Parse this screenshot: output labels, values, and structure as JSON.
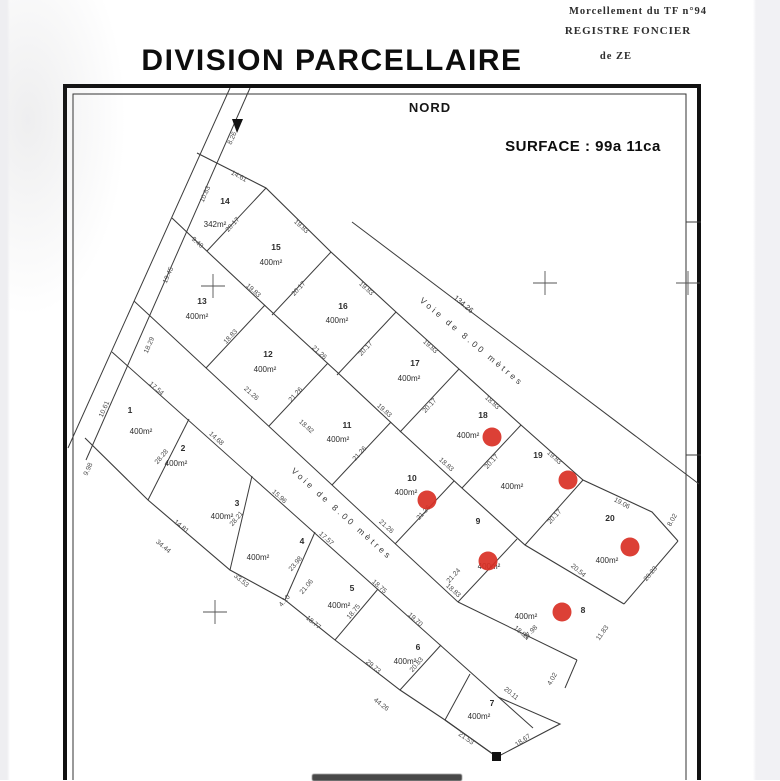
{
  "header": {
    "line1": "Morcellement  du  TF  n°94",
    "line2": "REGISTRE  FONCIER",
    "line3": "de  ZE"
  },
  "title": "DIVISION PARCELLAIRE",
  "north_label": "NORD",
  "surface_label": "SURFACE : 99a 11ca",
  "road_label": "Voie  de  8.00  mètres",
  "road1_length": "134.26",
  "colors": {
    "dot": "#d93025",
    "line": "#3c3c3c",
    "text": "#3a3a3a",
    "frame": "#111111"
  },
  "parcels": [
    {
      "num": "14",
      "area": "342m²",
      "nx": 225,
      "ny": 204,
      "ax": 215,
      "ay": 227
    },
    {
      "num": "15",
      "area": "400m²",
      "nx": 276,
      "ny": 250,
      "ax": 271,
      "ay": 265
    },
    {
      "num": "16",
      "area": "400m²",
      "nx": 343,
      "ny": 309,
      "ax": 337,
      "ay": 323
    },
    {
      "num": "17",
      "area": "400m²",
      "nx": 415,
      "ny": 366,
      "ax": 409,
      "ay": 381
    },
    {
      "num": "18",
      "area": "400m²",
      "nx": 483,
      "ny": 418,
      "ax": 468,
      "ay": 438,
      "dx": 492,
      "dy": 437
    },
    {
      "num": "19",
      "area": "400m²",
      "nx": 538,
      "ny": 458,
      "ax": 512,
      "ay": 489,
      "dx": 568,
      "dy": 480
    },
    {
      "num": "20",
      "area": "400m²",
      "nx": 610,
      "ny": 521,
      "ax": 607,
      "ay": 563,
      "dx": 630,
      "dy": 547
    },
    {
      "num": "13",
      "area": "400m²",
      "nx": 202,
      "ny": 304,
      "ax": 197,
      "ay": 319
    },
    {
      "num": "12",
      "area": "400m²",
      "nx": 268,
      "ny": 357,
      "ax": 265,
      "ay": 372
    },
    {
      "num": "11",
      "area": "400m²",
      "nx": 347,
      "ny": 428,
      "ax": 338,
      "ay": 442
    },
    {
      "num": "10",
      "area": "400m²",
      "nx": 412,
      "ny": 481,
      "ax": 406,
      "ay": 495,
      "dx": 427,
      "dy": 500
    },
    {
      "num": "9",
      "area": "400m²",
      "nx": 478,
      "ny": 524,
      "ax": 489,
      "ay": 569,
      "dx": 488,
      "dy": 561
    },
    {
      "num": "8",
      "area": "400m²",
      "nx": 583,
      "ny": 613,
      "ax": 526,
      "ay": 619,
      "dx": 562,
      "dy": 612
    },
    {
      "num": "1",
      "area": "400m²",
      "nx": 130,
      "ny": 413,
      "ax": 141,
      "ay": 434
    },
    {
      "num": "2",
      "area": "400m²",
      "nx": 183,
      "ny": 451,
      "ax": 176,
      "ay": 466
    },
    {
      "num": "3",
      "area": "400m²",
      "nx": 237,
      "ny": 506,
      "ax": 222,
      "ay": 519
    },
    {
      "num": "4",
      "area": "400m²",
      "nx": 302,
      "ny": 544,
      "ax": 258,
      "ay": 560
    },
    {
      "num": "5",
      "area": "400m²",
      "nx": 352,
      "ny": 591,
      "ax": 339,
      "ay": 608
    },
    {
      "num": "6",
      "area": "400m²",
      "nx": 418,
      "ny": 650,
      "ax": 405,
      "ay": 664
    },
    {
      "num": "7",
      "area": "400m²",
      "nx": 492,
      "ny": 706,
      "ax": 479,
      "ay": 719
    }
  ],
  "dims": [
    {
      "t": "8.26",
      "x": 234,
      "y": 139,
      "r": -66
    },
    {
      "t": "10.83",
      "x": 207,
      "y": 195,
      "r": -66
    },
    {
      "t": "19.45",
      "x": 170,
      "y": 276,
      "r": -66
    },
    {
      "t": "18.29",
      "x": 151,
      "y": 346,
      "r": -66
    },
    {
      "t": "10.61",
      "x": 106,
      "y": 410,
      "r": -66
    },
    {
      "t": "9.98",
      "x": 90,
      "y": 470,
      "r": -66
    },
    {
      "t": "14.61",
      "x": 238,
      "y": 178,
      "r": 28
    },
    {
      "t": "19.83",
      "x": 300,
      "y": 228,
      "r": 42
    },
    {
      "t": "19.83",
      "x": 365,
      "y": 290,
      "r": 42
    },
    {
      "t": "19.83",
      "x": 429,
      "y": 348,
      "r": 42
    },
    {
      "t": "18.83",
      "x": 491,
      "y": 404,
      "r": 42
    },
    {
      "t": "19.83",
      "x": 553,
      "y": 459,
      "r": 42
    },
    {
      "t": "19.06",
      "x": 621,
      "y": 505,
      "r": 28
    },
    {
      "t": "8.02",
      "x": 674,
      "y": 521,
      "r": -60
    },
    {
      "t": "20.17",
      "x": 234,
      "y": 226,
      "r": -47
    },
    {
      "t": "20.17",
      "x": 300,
      "y": 290,
      "r": -47
    },
    {
      "t": "20.17",
      "x": 367,
      "y": 350,
      "r": -47
    },
    {
      "t": "20.17",
      "x": 431,
      "y": 407,
      "r": -47
    },
    {
      "t": "20.17",
      "x": 493,
      "y": 463,
      "r": -47
    },
    {
      "t": "20.17",
      "x": 556,
      "y": 518,
      "r": -47
    },
    {
      "t": "9.40",
      "x": 196,
      "y": 244,
      "r": 42
    },
    {
      "t": "19.83",
      "x": 252,
      "y": 292,
      "r": 42
    },
    {
      "t": "21.26",
      "x": 318,
      "y": 354,
      "r": 42
    },
    {
      "t": "19.83",
      "x": 383,
      "y": 412,
      "r": 42
    },
    {
      "t": "18.83",
      "x": 445,
      "y": 466,
      "r": 42
    },
    {
      "t": "20.54",
      "x": 577,
      "y": 572,
      "r": 40
    },
    {
      "t": "18.83",
      "x": 232,
      "y": 338,
      "r": -47
    },
    {
      "t": "21.26",
      "x": 297,
      "y": 396,
      "r": -47
    },
    {
      "t": "21.26",
      "x": 361,
      "y": 455,
      "r": -47
    },
    {
      "t": "21.26",
      "x": 425,
      "y": 514,
      "r": -47
    },
    {
      "t": "21.24",
      "x": 455,
      "y": 577,
      "r": -47
    },
    {
      "t": "27.98",
      "x": 532,
      "y": 634,
      "r": -47
    },
    {
      "t": "21.26",
      "x": 250,
      "y": 395,
      "r": 42
    },
    {
      "t": "18.82",
      "x": 305,
      "y": 428,
      "r": 42
    },
    {
      "t": "21.26",
      "x": 385,
      "y": 528,
      "r": 42
    },
    {
      "t": "18.83",
      "x": 452,
      "y": 592,
      "r": 42
    },
    {
      "t": "18.89",
      "x": 520,
      "y": 634,
      "r": 40
    },
    {
      "t": "11.83",
      "x": 604,
      "y": 634,
      "r": -55
    },
    {
      "t": "20.23",
      "x": 652,
      "y": 575,
      "r": -50
    },
    {
      "t": "17.54",
      "x": 155,
      "y": 390,
      "r": 42
    },
    {
      "t": "14.68",
      "x": 215,
      "y": 440,
      "r": 42
    },
    {
      "t": "15.96",
      "x": 278,
      "y": 498,
      "r": 42
    },
    {
      "t": "17.57",
      "x": 325,
      "y": 540,
      "r": 42
    },
    {
      "t": "18.75",
      "x": 378,
      "y": 588,
      "r": 42
    },
    {
      "t": "19.70",
      "x": 414,
      "y": 621,
      "r": 42
    },
    {
      "t": "20.11",
      "x": 510,
      "y": 695,
      "r": 40
    },
    {
      "t": "28.28",
      "x": 163,
      "y": 458,
      "r": -50
    },
    {
      "t": "28.21",
      "x": 238,
      "y": 520,
      "r": -50
    },
    {
      "t": "23.98",
      "x": 297,
      "y": 565,
      "r": -50
    },
    {
      "t": "21.06",
      "x": 308,
      "y": 588,
      "r": -50
    },
    {
      "t": "18.75",
      "x": 355,
      "y": 613,
      "r": -50
    },
    {
      "t": "20.83",
      "x": 418,
      "y": 666,
      "r": -50
    },
    {
      "t": "14.81",
      "x": 180,
      "y": 528,
      "r": 40
    },
    {
      "t": "34.44",
      "x": 162,
      "y": 548,
      "r": 40
    },
    {
      "t": "33.53",
      "x": 240,
      "y": 582,
      "r": 40
    },
    {
      "t": "4.10",
      "x": 286,
      "y": 602,
      "r": -50
    },
    {
      "t": "18.77",
      "x": 312,
      "y": 624,
      "r": 40
    },
    {
      "t": "29.73",
      "x": 372,
      "y": 668,
      "r": 40
    },
    {
      "t": "44.26",
      "x": 380,
      "y": 706,
      "r": 38
    },
    {
      "t": "21.53",
      "x": 465,
      "y": 740,
      "r": 35
    },
    {
      "t": "18.67",
      "x": 524,
      "y": 742,
      "r": -35
    },
    {
      "t": "4.02",
      "x": 554,
      "y": 680,
      "r": -60
    }
  ],
  "map": {
    "segments": [
      [
        230,
        88,
        68,
        448
      ],
      [
        250,
        88,
        86,
        460
      ],
      [
        352,
        222,
        699,
        484
      ],
      [
        266,
        188,
        207,
        251
      ],
      [
        331,
        252,
        272,
        315
      ],
      [
        396,
        312,
        337,
        375
      ],
      [
        459,
        369,
        400,
        432
      ],
      [
        521,
        425,
        462,
        488
      ],
      [
        583,
        480,
        525,
        545
      ],
      [
        678,
        541,
        624,
        604
      ],
      [
        134,
        301,
        458,
        602
      ],
      [
        458,
        602,
        577,
        660
      ],
      [
        265,
        305,
        206,
        368
      ],
      [
        328,
        363,
        269,
        426
      ],
      [
        391,
        422,
        332,
        485
      ],
      [
        454,
        481,
        395,
        544
      ],
      [
        517,
        539,
        458,
        602
      ],
      [
        112,
        352,
        533,
        728
      ],
      [
        189,
        419,
        148,
        500
      ],
      [
        252,
        476,
        230,
        570
      ],
      [
        315,
        532,
        285,
        600
      ],
      [
        378,
        589,
        335,
        640
      ],
      [
        441,
        645,
        400,
        690
      ],
      [
        470,
        674,
        445,
        720
      ],
      [
        577,
        660,
        565,
        688
      ],
      [
        686,
        222,
        701,
        222
      ],
      [
        686,
        455,
        701,
        455
      ]
    ],
    "polylines": [
      [
        197,
        153,
        266,
        188,
        331,
        252,
        396,
        312,
        459,
        369,
        521,
        425,
        583,
        480,
        652,
        512,
        678,
        541
      ],
      [
        172,
        218,
        211,
        255,
        274,
        314,
        337,
        372,
        400,
        431,
        463,
        489,
        525,
        545,
        624,
        604
      ],
      [
        85,
        438,
        148,
        500,
        230,
        570,
        285,
        600,
        335,
        640,
        400,
        690,
        445,
        720,
        497,
        757
      ],
      [
        498,
        697,
        560,
        724,
        497,
        757,
        445,
        720
      ]
    ],
    "crosses": [
      [
        213,
        286
      ],
      [
        545,
        283
      ],
      [
        215,
        612
      ],
      [
        688,
        283
      ]
    ],
    "markers": {
      "arrow": [
        232,
        119,
        243,
        119,
        237,
        133
      ],
      "square": [
        492,
        752,
        9,
        9
      ]
    },
    "road1_label": {
      "x": 470,
      "y": 344,
      "r": 40
    },
    "road1_len_pos": {
      "x": 462,
      "y": 306,
      "r": 40
    },
    "road2_label": {
      "x": 340,
      "y": 516,
      "r": 42
    }
  }
}
